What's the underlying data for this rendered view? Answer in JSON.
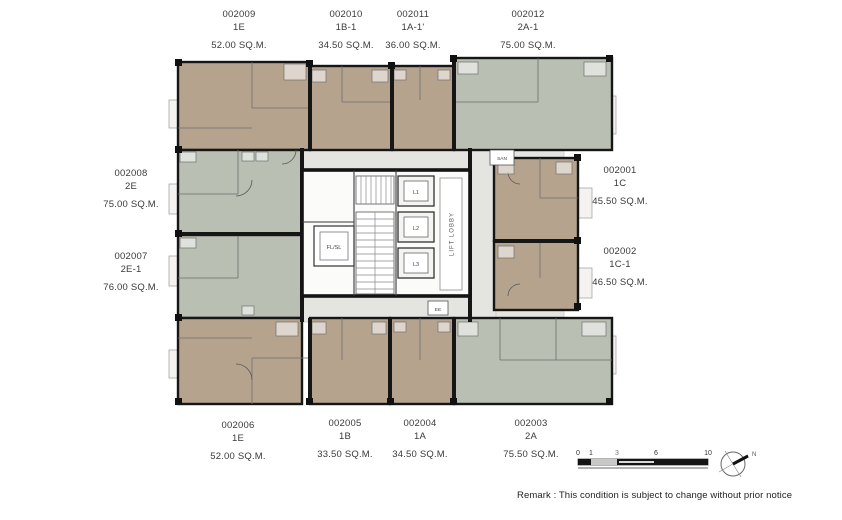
{
  "plan": {
    "units": [
      {
        "id": "002009",
        "type": "1E",
        "area": "52.00 SQ.M."
      },
      {
        "id": "002010",
        "type": "1B-1",
        "area": "34.50 SQ.M."
      },
      {
        "id": "002011",
        "type": "1A-1'",
        "area": "36.00 SQ.M."
      },
      {
        "id": "002012",
        "type": "2A-1",
        "area": "75.00 SQ.M."
      },
      {
        "id": "002008",
        "type": "2E",
        "area": "75.00 SQ.M."
      },
      {
        "id": "002007",
        "type": "2E-1",
        "area": "76.00 SQ.M."
      },
      {
        "id": "002001",
        "type": "1C",
        "area": "45.50 SQ.M."
      },
      {
        "id": "002002",
        "type": "1C-1",
        "area": "46.50 SQ.M."
      },
      {
        "id": "002006",
        "type": "1E",
        "area": "52.00 SQ.M."
      },
      {
        "id": "002005",
        "type": "1B",
        "area": "33.50 SQ.M."
      },
      {
        "id": "002004",
        "type": "1A",
        "area": "34.50 SQ.M."
      },
      {
        "id": "002003",
        "type": "2A",
        "area": "75.50 SQ.M."
      }
    ],
    "core": {
      "lifts": [
        "L1",
        "L2",
        "L3"
      ],
      "fire_lift": "FL/SL",
      "lobby": "LIFT LOBBY",
      "shaft_san": "SAN",
      "shaft_ee": "EE"
    },
    "colors": {
      "unit_tan": "#b5a38e",
      "unit_green": "#b9bfb2",
      "corridor": "#e4e4e1",
      "wall": "#161616"
    }
  },
  "scale_bar": {
    "labels": [
      "0",
      "1",
      "3",
      "6",
      "10"
    ]
  },
  "compass": {
    "label": "N"
  },
  "remark": "Remark : This condition is subject to change without prior notice"
}
